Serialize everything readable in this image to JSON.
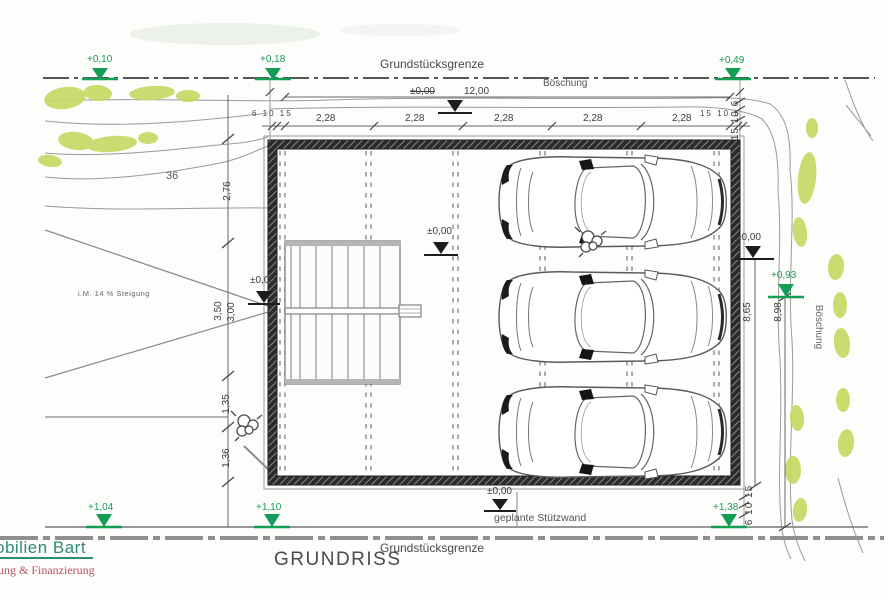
{
  "title": "GRUNDRISS",
  "boundaries": {
    "top_label": "Grundstücksgrenze",
    "bottom_label": "Grundstücksgrenze"
  },
  "terrain": {
    "slope_top": "Böschung",
    "slope_right": "Böschung",
    "parcel_number": "36",
    "ramp_slope_note": "i.M. 14 % Steigung",
    "retaining_wall_label": "geplante Stützwand"
  },
  "elevations": {
    "top": [
      {
        "label": "+0,10"
      },
      {
        "label": "+0,18"
      },
      {
        "label": "+0,49"
      }
    ],
    "bottom": [
      {
        "label": "+1,04"
      },
      {
        "label": "+1,10"
      },
      {
        "label": "+1,38"
      }
    ],
    "right_green": "+0,93",
    "zero_top": "±0,00",
    "zero_interior": "±0,00",
    "zero_entrance": "±0,00",
    "zero_right": "±0,00",
    "zero_bottom": "±0,00"
  },
  "dimensions": {
    "overall_width": "12,00",
    "bay_widths": [
      "2,28",
      "2,28",
      "2,28",
      "2,28",
      "2,28"
    ],
    "wall_layers_left": "6 10 15",
    "wall_layers_right": "15 10 6",
    "wall_layers_right_top_vertical": "15 10 6",
    "wall_layers_right_bottom_vertical": "6 10 15",
    "left_chain": [
      "2,76",
      "3,50",
      "3,00",
      "1,35",
      "1,36"
    ],
    "right_depths": [
      "8,65",
      "8,98"
    ]
  },
  "logo": {
    "line1": "obilien Bart",
    "line2": "ung & Finanzierung"
  },
  "colors": {
    "marker_green": "#129e56",
    "vegetation": "#c6d75f",
    "wall_dark": "#2b2b2b",
    "logo_teal": "#2f8a78",
    "logo_red": "#b84f66"
  }
}
